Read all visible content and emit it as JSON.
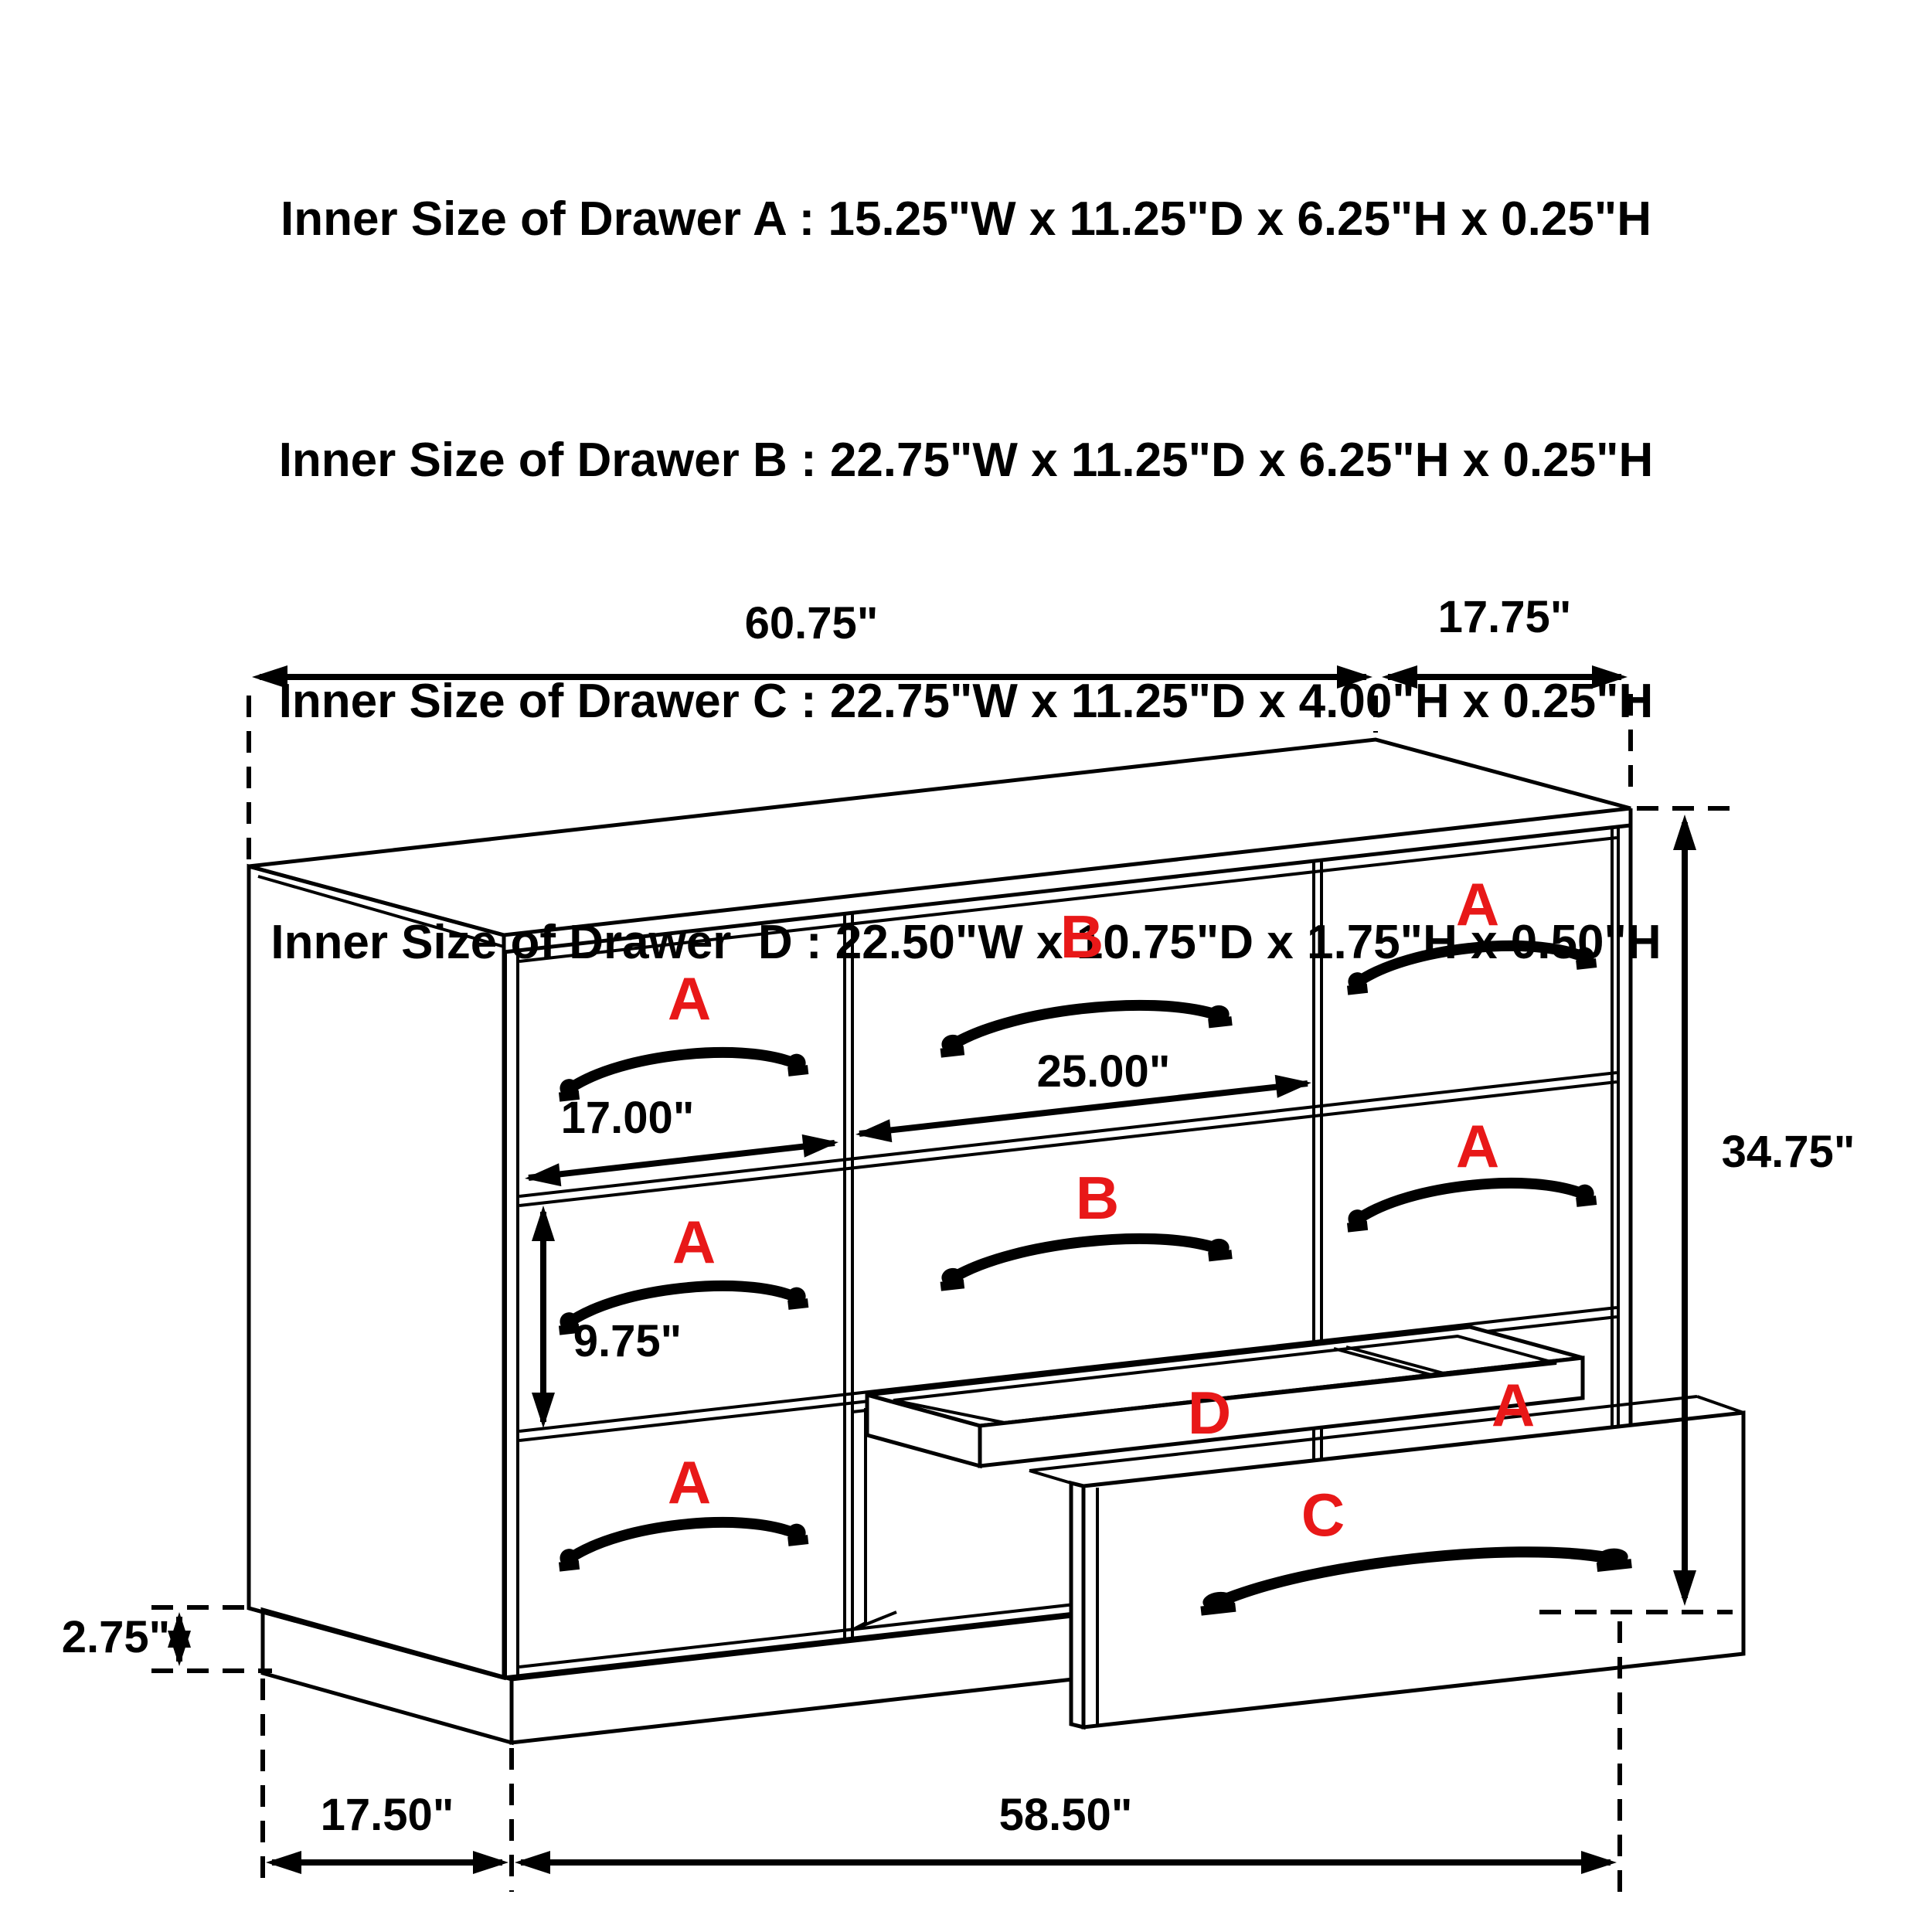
{
  "title_lines": [
    "Inner Size of Drawer A : 15.25\"W x 11.25\"D x 6.25\"H x 0.25\"H",
    "Inner Size of Drawer B : 22.75\"W x 11.25\"D x 6.25\"H x 0.25\"H",
    "Inner Size of Drawer C : 22.75\"W x 11.25\"D x 4.00\"H x 0.25\"H",
    "Inner Size of Drawer  D : 22.50\"W x 10.75\"D x 1.75\"H x 0.50\"H"
  ],
  "dimensions": {
    "top_width": "60.75\"",
    "top_depth": "17.75\"",
    "overall_height": "34.75\"",
    "drawer_b_width": "25.00\"",
    "drawer_a_width": "17.00\"",
    "drawer_a_height": "9.75\"",
    "base_height": "2.75\"",
    "bottom_depth": "17.50\"",
    "bottom_width": "58.50\""
  },
  "drawer_labels": {
    "a": "A",
    "b": "B",
    "c": "C",
    "d": "D"
  },
  "colors": {
    "line": "#000000",
    "label_red": "#e81818",
    "background": "#ffffff"
  }
}
